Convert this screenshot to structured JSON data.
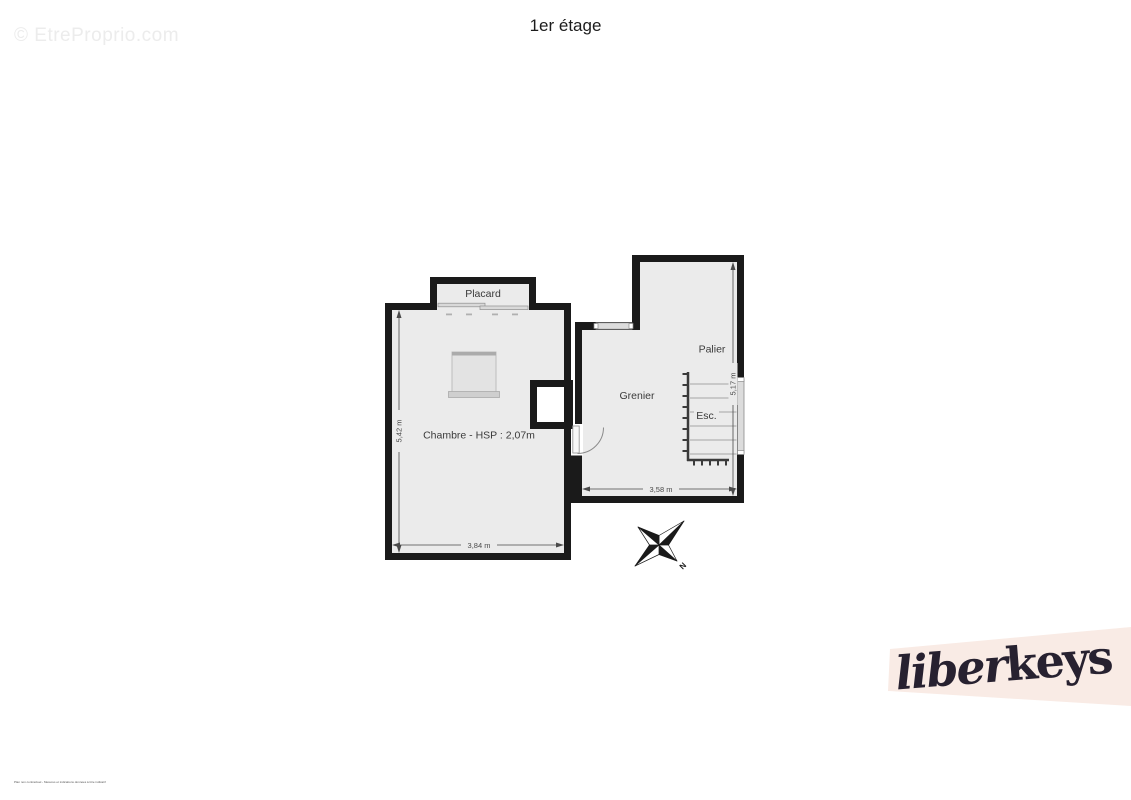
{
  "page": {
    "title": "1er étage",
    "watermark": "© EtreProprio.com",
    "disclaimer": "Plan non contractuel - Mesures et indications données à titre indicatif"
  },
  "floorplan": {
    "labels": {
      "placard": "Placard",
      "chambre": "Chambre - HSP : 2,07m",
      "grenier": "Grenier",
      "palier": "Palier",
      "stairs": "Esc."
    },
    "dimensions": {
      "chambre_height": "5,42 m",
      "chambre_width": "3,84 m",
      "grenier_height": "5,17 m",
      "grenier_width": "3,58 m"
    },
    "compass": {
      "north_label": "N"
    },
    "colors": {
      "floor": "#ebebeb",
      "wall": "#1a1a1a",
      "window": "#dcdcdc",
      "dimension": "#4a4a4a"
    }
  },
  "logo": {
    "script_part": "liber",
    "bold_part": "keys",
    "band_color": "#f9ebe5",
    "text_color": "#272130"
  }
}
